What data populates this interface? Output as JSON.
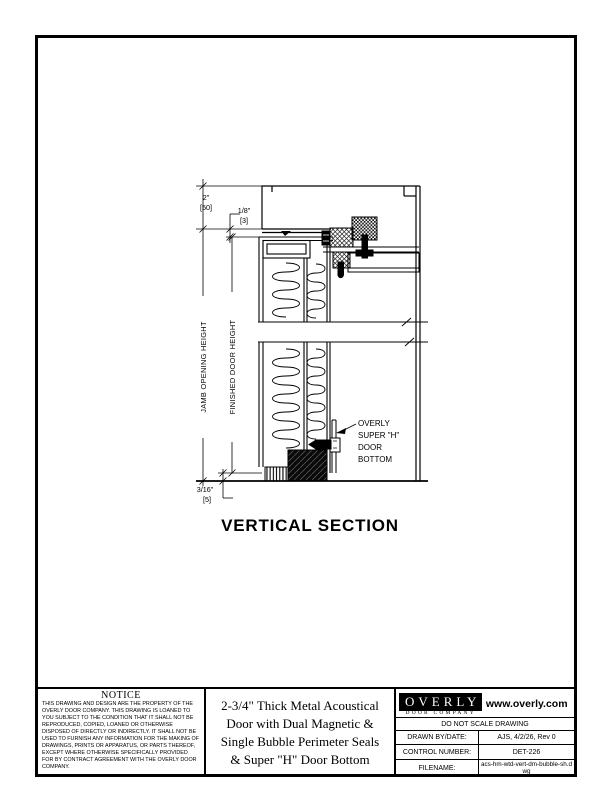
{
  "drawing": {
    "section_title": "VERTICAL SECTION",
    "dim_top": {
      "primary": "2\"",
      "secondary": "[50]"
    },
    "dim_head_gap": {
      "primary": "1/8\"",
      "secondary": "[3]"
    },
    "dim_bottom": {
      "primary": "3/16\"",
      "secondary": "[5]"
    },
    "label_jamb": "JAMB OPENING HEIGHT",
    "label_door": "FINISHED DOOR HEIGHT",
    "callout": {
      "line1": "OVERLY",
      "line2": "SUPER \"H\"",
      "line3": "DOOR",
      "line4": "BOTTOM"
    }
  },
  "title_block": {
    "notice": {
      "heading": "NOTICE",
      "body": "THIS DRAWING AND DESIGN ARE THE PROPERTY OF THE OVERLY DOOR COMPANY.  THIS DRAWING IS LOANED TO YOU SUBJECT TO THE CONDITION THAT IT SHALL NOT BE REPRODUCED, COPIED, LOANED OR OTHERWISE DISPOSED OF DIRECTLY OR INDIRECTLY. IT SHALL NOT BE USED TO FURNISH ANY INFORMATION FOR THE MAKING OF DRAWINGS, PRINTS OR APPARATUS, OR PARTS THEREOF, EXCEPT WHERE OTHERWISE SPECIFICALLY PROVIDED FOR BY CONTRACT AGREEMENT WITH THE OVERLY DOOR COMPANY."
    },
    "drawing_title": {
      "line1": "2-3/4\" Thick Metal Acoustical",
      "line2": "Door with Dual Magnetic &",
      "line3": "Single Bubble Perimeter Seals",
      "line4": "& Super \"H\" Door Bottom"
    },
    "company": {
      "logo_text": "OVERLY",
      "logo_sub": "DOOR COMPANY",
      "website": "www.overly.com"
    },
    "do_not_scale": "DO NOT SCALE DRAWING",
    "fields": [
      {
        "label": "DRAWN BY/DATE:",
        "value": "AJS, 4/2/26, Rev 0"
      },
      {
        "label": "CONTROL NUMBER:",
        "value": "DET-226"
      },
      {
        "label": "FILENAME:",
        "value": "acs-hm-wtd-vert-dm-bubble-sh.dwg"
      }
    ]
  }
}
